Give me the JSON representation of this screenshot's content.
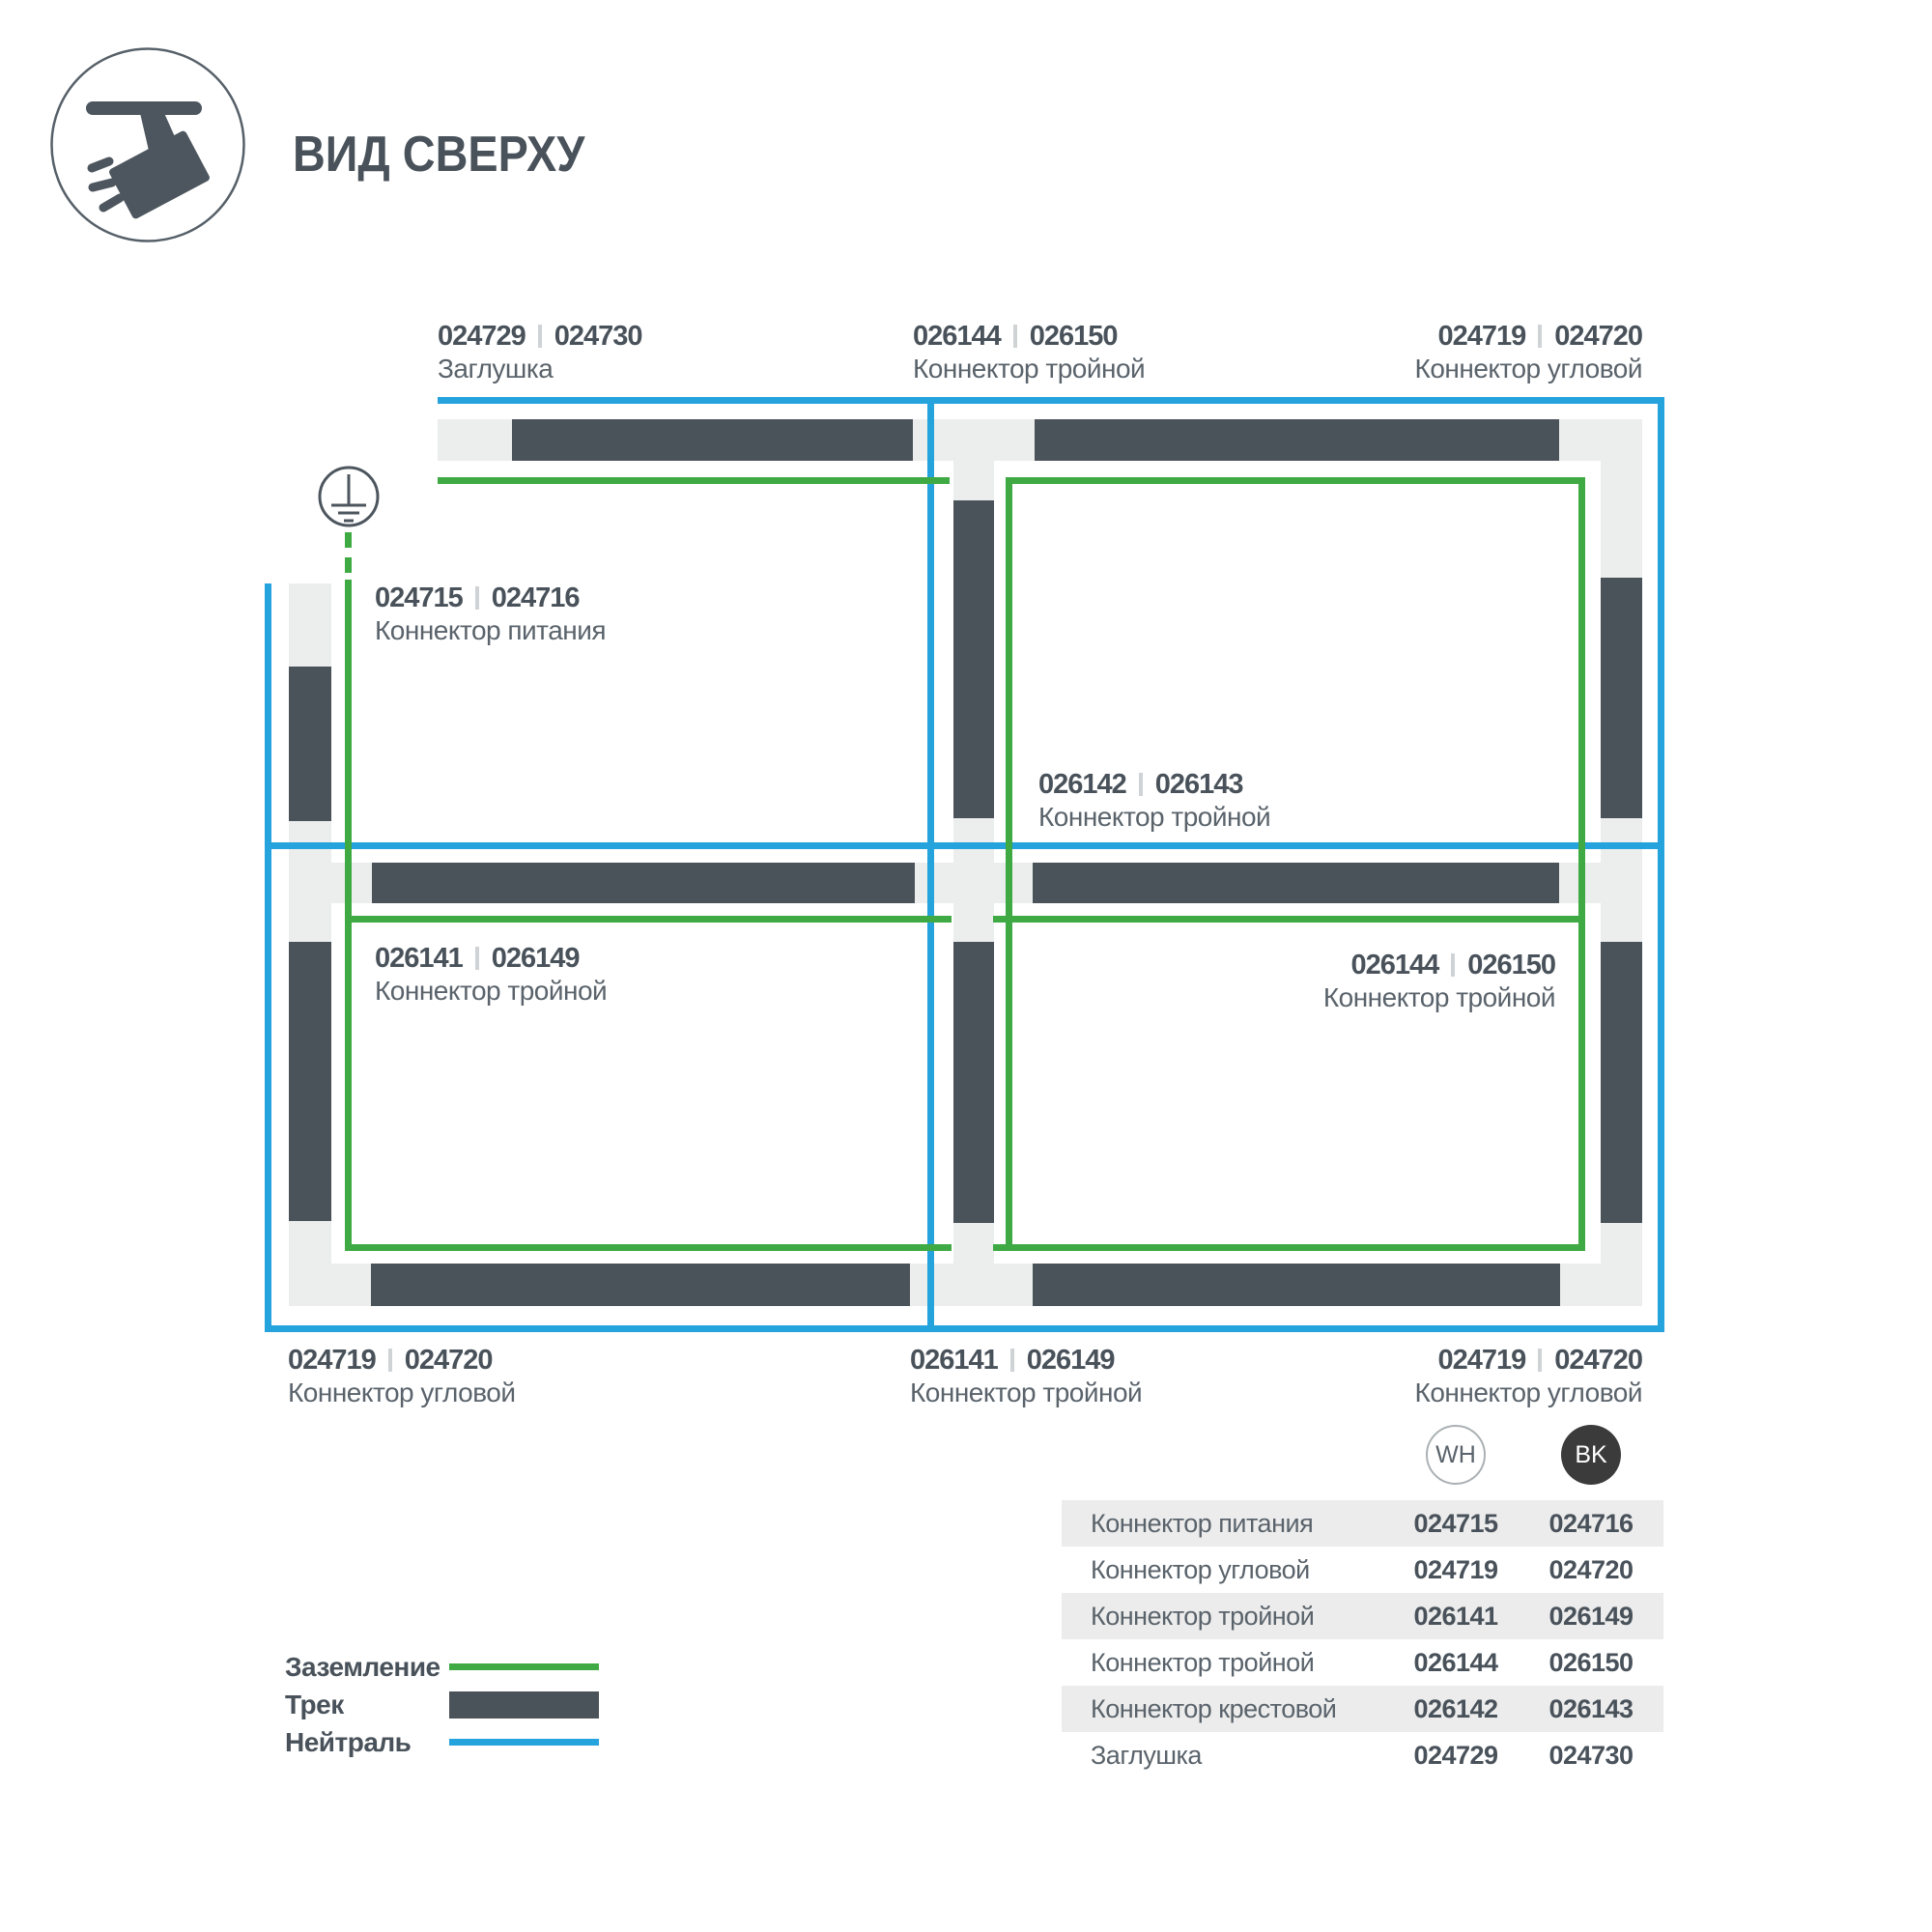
{
  "title": "ВИД СВЕРХУ",
  "icons": {
    "logo": "track-spotlight-icon",
    "earth": "earth-ground-icon"
  },
  "colors": {
    "track": "#4b535a",
    "connector": "#eceeee",
    "neutral": "#24a3dd",
    "ground": "#3faa43",
    "text_dark": "#49525a",
    "text_medium": "#5a636b",
    "row_shade": "#ececec",
    "badge_black": "#3b3b3c"
  },
  "diagram_labels": {
    "top_left": {
      "wh": "024729",
      "bk": "024730",
      "name": "Заглушка"
    },
    "top_center": {
      "wh": "026144",
      "bk": "026150",
      "name": "Коннектор тройной"
    },
    "top_right": {
      "wh": "024719",
      "bk": "024720",
      "name": "Коннектор угловой"
    },
    "power": {
      "wh": "024715",
      "bk": "024716",
      "name": "Коннектор питания"
    },
    "center": {
      "wh": "026142",
      "bk": "026143",
      "name": "Коннектор тройной"
    },
    "mid_left": {
      "wh": "026141",
      "bk": "026149",
      "name": "Коннектор тройной"
    },
    "mid_right": {
      "wh": "026144",
      "bk": "026150",
      "name": "Коннектор тройной"
    },
    "bottom_left": {
      "wh": "024719",
      "bk": "024720",
      "name": "Коннектор угловой"
    },
    "bottom_center": {
      "wh": "026141",
      "bk": "026149",
      "name": "Коннектор тройной"
    },
    "bottom_right": {
      "wh": "024719",
      "bk": "024720",
      "name": "Коннектор угловой"
    }
  },
  "badges": {
    "wh": "WH",
    "bk": "BK"
  },
  "table": {
    "rows": [
      {
        "name": "Коннектор питания",
        "wh": "024715",
        "bk": "024716"
      },
      {
        "name": "Коннектор угловой",
        "wh": "024719",
        "bk": "024720"
      },
      {
        "name": "Коннектор тройной",
        "wh": "026141",
        "bk": "026149"
      },
      {
        "name": "Коннектор тройной",
        "wh": "026144",
        "bk": "026150"
      },
      {
        "name": "Коннектор крестовой",
        "wh": "026142",
        "bk": "026143"
      },
      {
        "name": "Заглушка",
        "wh": "024729",
        "bk": "024730"
      }
    ]
  },
  "legend": {
    "items": [
      {
        "label": "Заземление",
        "type": "ground-line"
      },
      {
        "label": "Трек",
        "type": "track-bar"
      },
      {
        "label": "Нейтраль",
        "type": "neutral-line"
      }
    ]
  }
}
